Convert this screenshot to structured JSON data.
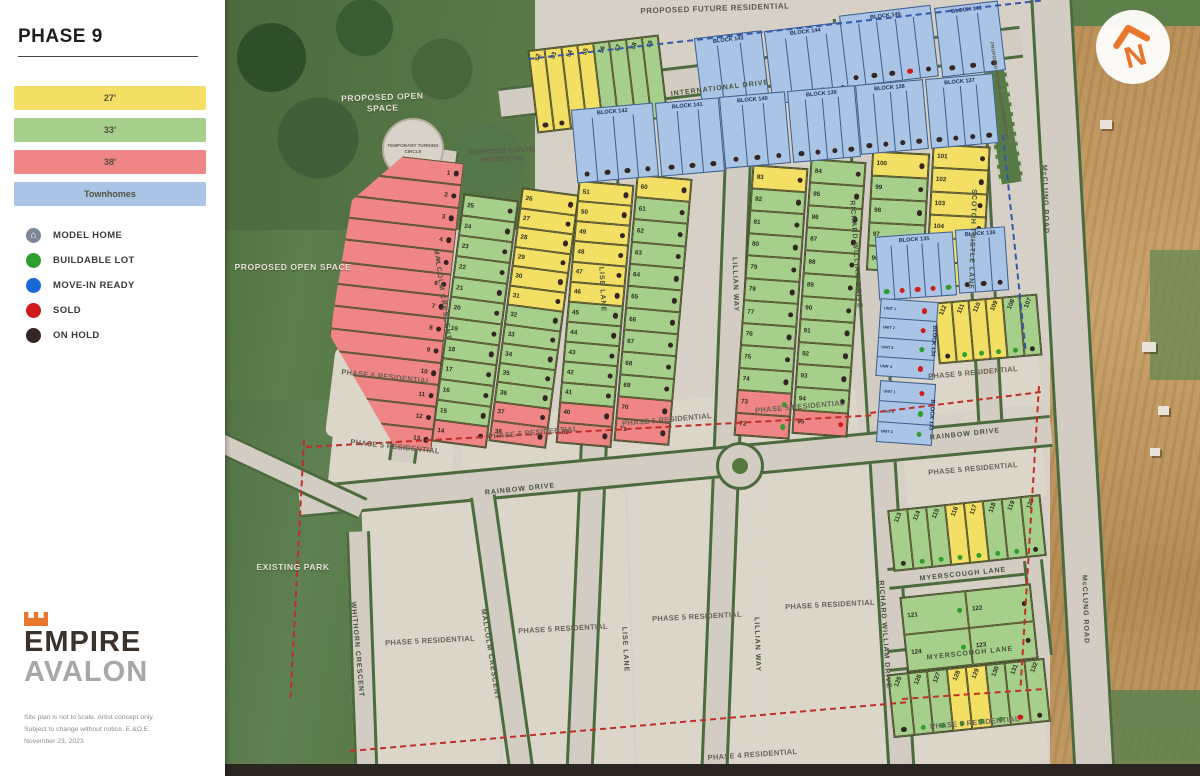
{
  "sidebar": {
    "title": "PHASE 9",
    "size_legend": [
      {
        "label": "27'",
        "color": "#f2df63"
      },
      {
        "label": "33'",
        "color": "#a6cf8b"
      },
      {
        "label": "38'",
        "color": "#ef8585"
      },
      {
        "label": "Townhomes",
        "color": "#a9c4e4"
      }
    ],
    "status_legend": [
      {
        "label": "MODEL HOME"
      },
      {
        "label": "BUILDABLE LOT",
        "color": "#2f9e2f"
      },
      {
        "label": "MOVE-IN READY",
        "color": "#1868d8"
      },
      {
        "label": "SOLD",
        "color": "#cf1b1b"
      },
      {
        "label": "ON HOLD",
        "color": "#352525"
      }
    ],
    "logo": {
      "brand": "EMPIRE",
      "community": "AVALON"
    },
    "disclaimer_lines": [
      "Site plan is not to scale. Artist concept only.",
      "Subject to change without notice. E.&O.E.",
      "November 23, 2023"
    ]
  },
  "map": {
    "north": "N",
    "area_labels": {
      "proposed_future_residential": "PROPOSED FUTURE RESIDENTIAL",
      "proposed_open_space": "PROPOSED OPEN SPACE",
      "temporary_turning_circle": "TEMPORARY TURNING CIRCLE",
      "proposed_future_road_connection": "PROPOSED FUTURE ROAD CONNECTION",
      "existing_park": "EXISTING PARK",
      "phase_6_residential": "PHASE 6 RESIDENTIAL",
      "phase_5_residential": "PHASE 5 RESIDENTIAL",
      "phase_9_residential": "PHASE 9 RESIDENTIAL",
      "phase_4_residential": "PHASE 4 RESIDENTIAL"
    },
    "streets": {
      "international": "INTERNATIONAL DRIVE",
      "malcolm": "MALCOLM CRESCENT",
      "lise": "LISE LANE",
      "lillian": "LILLIAN WAY",
      "richard_william": "RICHARD WILLIAM DRIVE",
      "scotch_thistle": "SCOTCH THISTLE LANE",
      "mcclung": "McCLUNG ROAD",
      "rainbow": "RAINBOW DRIVE",
      "myerscough": "MYERSCOUGH LANE",
      "whithorn": "WHITHORN CRESCENT"
    }
  },
  "colors": {
    "lot": {
      "y": "#f2df63",
      "g": "#a6cf8b",
      "r": "#ef8585",
      "b": "#a9c4e4"
    },
    "status": {
      "h": "#352525",
      "b": "#2f9e2f",
      "s": "#cf1b1b",
      "m": "#1868d8"
    }
  },
  "lot_groups": {
    "top_row": [
      [
        52,
        "y",
        "h"
      ],
      [
        53,
        "y",
        "h"
      ],
      [
        54,
        "y",
        "h"
      ],
      [
        55,
        "y",
        "h"
      ],
      [
        56,
        "g",
        "h"
      ],
      [
        57,
        "g",
        "h"
      ],
      [
        58,
        "g",
        "h"
      ],
      [
        59,
        "g",
        "h"
      ]
    ],
    "red_west": [
      [
        1,
        "r",
        "h"
      ],
      [
        2,
        "r",
        "h"
      ],
      [
        3,
        "r",
        "h"
      ],
      [
        4,
        "r",
        "h"
      ],
      [
        5,
        "r",
        "h"
      ],
      [
        6,
        "r",
        "h"
      ],
      [
        7,
        "r",
        "h"
      ],
      [
        8,
        "r",
        "h"
      ],
      [
        9,
        "r",
        "h"
      ],
      [
        10,
        "r",
        "h"
      ],
      [
        11,
        "r",
        "h"
      ],
      [
        12,
        "r",
        "h"
      ],
      [
        13,
        "r",
        "h"
      ]
    ],
    "malcolm_west": [
      [
        25,
        "g",
        "h"
      ],
      [
        24,
        "g",
        "h"
      ],
      [
        23,
        "g",
        "h"
      ],
      [
        22,
        "g",
        "h"
      ],
      [
        21,
        "g",
        "h"
      ],
      [
        20,
        "g",
        "h"
      ],
      [
        19,
        "g",
        "h"
      ],
      [
        18,
        "g",
        "h"
      ],
      [
        17,
        "g",
        "h"
      ],
      [
        16,
        "g",
        "h"
      ],
      [
        15,
        "g",
        "h"
      ],
      [
        14,
        "r",
        "h"
      ]
    ],
    "malcolm_east": [
      [
        26,
        "y",
        "h"
      ],
      [
        27,
        "y",
        "h"
      ],
      [
        28,
        "y",
        "h"
      ],
      [
        29,
        "y",
        "h"
      ],
      [
        30,
        "y",
        "h"
      ],
      [
        31,
        "y",
        "h"
      ],
      [
        32,
        "g",
        "h"
      ],
      [
        33,
        "g",
        "h"
      ],
      [
        34,
        "g",
        "h"
      ],
      [
        35,
        "g",
        "h"
      ],
      [
        36,
        "g",
        "h"
      ],
      [
        37,
        "r",
        "h"
      ],
      [
        38,
        "r",
        "h"
      ]
    ],
    "lise_east": [
      [
        51,
        "y",
        "h"
      ],
      [
        50,
        "y",
        "h"
      ],
      [
        49,
        "y",
        "h"
      ],
      [
        48,
        "y",
        "h"
      ],
      [
        47,
        "y",
        "h"
      ],
      [
        46,
        "y",
        "h"
      ],
      [
        45,
        "g",
        "h"
      ],
      [
        44,
        "g",
        "h"
      ],
      [
        43,
        "g",
        "h"
      ],
      [
        42,
        "g",
        "h"
      ],
      [
        41,
        "g",
        "h"
      ],
      [
        40,
        "r",
        "h"
      ],
      [
        39,
        "r",
        "h"
      ]
    ],
    "lillian_west": [
      [
        60,
        "y",
        "h"
      ],
      [
        61,
        "g",
        "h"
      ],
      [
        62,
        "g",
        "h"
      ],
      [
        63,
        "g",
        "h"
      ],
      [
        64,
        "g",
        "h"
      ],
      [
        65,
        "g",
        "h"
      ],
      [
        66,
        "g",
        "h"
      ],
      [
        67,
        "g",
        "h"
      ],
      [
        68,
        "g",
        "h"
      ],
      [
        69,
        "g",
        "h"
      ],
      [
        70,
        "r",
        "h"
      ],
      [
        71,
        "r",
        "h"
      ]
    ],
    "lillian_east": [
      [
        83,
        "y",
        "h"
      ],
      [
        82,
        "g",
        "h"
      ],
      [
        81,
        "g",
        "h"
      ],
      [
        80,
        "g",
        "h"
      ],
      [
        79,
        "g",
        "h"
      ],
      [
        78,
        "g",
        "h"
      ],
      [
        77,
        "g",
        "h"
      ],
      [
        76,
        "g",
        "h"
      ],
      [
        75,
        "g",
        "h"
      ],
      [
        74,
        "g",
        "h"
      ],
      [
        73,
        "r",
        "b"
      ],
      [
        72,
        "r",
        "b"
      ]
    ],
    "richard_west": [
      [
        84,
        "g",
        "h"
      ],
      [
        85,
        "g",
        "h"
      ],
      [
        86,
        "g",
        "h"
      ],
      [
        87,
        "g",
        "h"
      ],
      [
        88,
        "g",
        "h"
      ],
      [
        89,
        "g",
        "h"
      ],
      [
        90,
        "g",
        "h"
      ],
      [
        91,
        "g",
        "h"
      ],
      [
        92,
        "g",
        "h"
      ],
      [
        93,
        "g",
        "h"
      ],
      [
        94,
        "g",
        "h"
      ],
      [
        95,
        "r",
        "s"
      ]
    ],
    "richard_east": [
      [
        100,
        "y",
        "h"
      ],
      [
        99,
        "g",
        "h"
      ],
      [
        98,
        "g",
        "h"
      ],
      [
        97,
        "g",
        "h"
      ],
      [
        96,
        "g",
        "h"
      ]
    ],
    "scotch_west": [
      [
        101,
        "y",
        "h"
      ],
      [
        102,
        "y",
        "h"
      ],
      [
        103,
        "y",
        "h"
      ],
      [
        104,
        "y",
        "h"
      ],
      [
        105,
        "y",
        "h"
      ],
      [
        106,
        "y",
        "h"
      ]
    ],
    "mid_right_strip": [
      [
        112,
        "y",
        "h"
      ],
      [
        111,
        "y",
        "b"
      ],
      [
        110,
        "y",
        "b"
      ],
      [
        109,
        "y",
        "b"
      ],
      [
        108,
        "g",
        "b"
      ],
      [
        107,
        "g",
        "h"
      ]
    ],
    "rainbow_south_row": [
      [
        113,
        "g",
        "h"
      ],
      [
        114,
        "g",
        "b"
      ],
      [
        115,
        "g",
        "b"
      ],
      [
        116,
        "y",
        "b"
      ],
      [
        117,
        "y",
        "b"
      ],
      [
        118,
        "g",
        "b"
      ],
      [
        119,
        "g",
        "b"
      ],
      [
        120,
        "g",
        "h"
      ]
    ],
    "myerscough_block": [
      [
        121,
        "g",
        "b"
      ],
      [
        122,
        "g",
        "h"
      ],
      [
        124,
        "g",
        "b"
      ],
      [
        123,
        "g",
        "h"
      ]
    ],
    "myerscough_south": [
      [
        125,
        "g",
        "h"
      ],
      [
        126,
        "g",
        "b"
      ],
      [
        127,
        "g",
        "b"
      ],
      [
        128,
        "y",
        "b"
      ],
      [
        129,
        "y",
        "b"
      ],
      [
        130,
        "g",
        "b"
      ],
      [
        131,
        "g",
        "s"
      ],
      [
        132,
        "g",
        "h"
      ]
    ]
  },
  "blocks": {
    "b143": {
      "label": "BLOCK 143",
      "units": [
        "h",
        "h",
        "h"
      ]
    },
    "b144": {
      "label": "BLOCK 144",
      "units": [
        "h",
        "h",
        "h",
        "h"
      ]
    },
    "b145": {
      "label": "BLOCK 145",
      "units": [
        "h",
        "h",
        "h",
        "s",
        "h"
      ]
    },
    "b146": {
      "label": "BLOCK 146",
      "units": [
        "h",
        "h",
        "h"
      ]
    },
    "b142": {
      "label": "BLOCK 142",
      "units": [
        "h",
        "h",
        "h",
        "h"
      ]
    },
    "b141": {
      "label": "BLOCK 141",
      "units": [
        "h",
        "h",
        "h"
      ]
    },
    "b140": {
      "label": "BLOCK 140",
      "units": [
        "h",
        "h",
        "h"
      ]
    },
    "b139": {
      "label": "BLOCK 139",
      "units": [
        "h",
        "h",
        "h",
        "h"
      ]
    },
    "b138": {
      "label": "BLOCK 138",
      "units": [
        "h",
        "h",
        "h",
        "h"
      ]
    },
    "b137": {
      "label": "BLOCK 137",
      "units": [
        "h",
        "h",
        "h",
        "h"
      ]
    },
    "b135": {
      "label": "BLOCK 135",
      "units": [
        "b",
        "s",
        "s",
        "s",
        "b"
      ]
    },
    "b136": {
      "label": "BLOCK 136",
      "units": [
        "h",
        "h",
        "h"
      ]
    },
    "b134": {
      "label": "BLOCK 134",
      "units": [
        "s",
        "s",
        "b",
        "s"
      ],
      "unit_labels": [
        "UNIT 1",
        "UNIT 2",
        "UNIT 3",
        "UNIT 4"
      ]
    },
    "b133": {
      "label": "BLOCK 133",
      "units": [
        "s",
        "b",
        "b"
      ],
      "unit_labels": [
        "UNIT 1",
        "UNIT 2",
        "UNIT 3"
      ]
    }
  }
}
